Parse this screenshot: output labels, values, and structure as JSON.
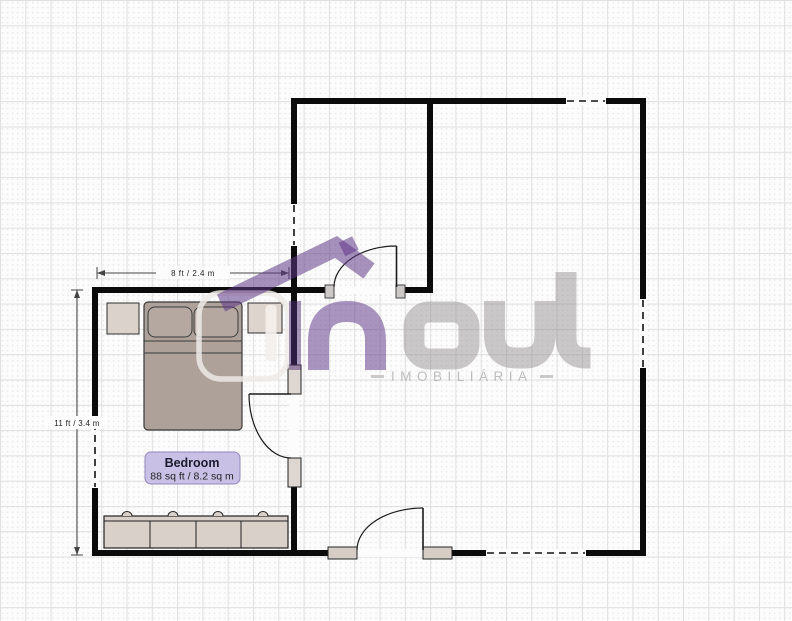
{
  "room": {
    "name": "Bedroom",
    "area": "88 sq ft / 8.2 sq m"
  },
  "dimensions": {
    "width": "8 ft / 2.4 m",
    "height": "11 ft / 3.4 m"
  },
  "watermark": {
    "brand": "inout",
    "brand_in_text": "in",
    "brand_out_text": "out",
    "subtitle": "IMOBILIÁRIA",
    "colors": {
      "purple": "#5f3787",
      "gray": "#8c8787",
      "outline": "#eeeae7"
    },
    "elements": [
      {
        "tag": "rect",
        "name": "logo-house-outline",
        "inter": false,
        "x": 199,
        "y": 293,
        "width": 89,
        "height": 86,
        "rx": 22,
        "fill": "none",
        "stroke": "rgba(238,234,231,0.85)",
        "stroke-width": 5.5
      },
      {
        "tag": "rect",
        "name": "logo-house-door",
        "inter": false,
        "x": 265.5,
        "y": 305,
        "width": 11,
        "height": 56,
        "rx": 3.5,
        "fill": "rgba(244,240,236,0.9)"
      },
      {
        "tag": "path",
        "name": "logo-roof",
        "inter": false,
        "d": "M221,303 L336,247 L369,271",
        "fill": "none",
        "stroke": "rgba(95,55,135,0.55)",
        "stroke-width": 19,
        "stroke-linejoin": "miter"
      },
      {
        "tag": "rect",
        "name": "logo-chimney",
        "inter": false,
        "x": 341,
        "y": 239,
        "width": 15,
        "height": 15,
        "transform": "rotate(-26 348 246)",
        "fill": "rgba(95,55,135,0.55)"
      },
      {
        "tag": "rect",
        "name": "logo-letter-i",
        "inter": false,
        "x": 289,
        "y": 301,
        "width": 12,
        "height": 69,
        "fill": "rgba(80,45,120,0.5)"
      },
      {
        "tag": "path",
        "name": "logo-letter-n",
        "inter": false,
        "d": "M318.5,370 L318.5,341 Q318.5,311.5 347,311.5 Q375.5,311.5 375.5,341 L375.5,370",
        "fill": "none",
        "stroke": "rgba(100,62,140,0.55)",
        "stroke-width": 21
      },
      {
        "tag": "rect",
        "name": "logo-letter-o",
        "inter": false,
        "x": 414,
        "y": 312,
        "width": 55,
        "height": 47,
        "rx": 15,
        "fill": "none",
        "stroke": "rgba(140,135,135,0.45)",
        "stroke-width": 21
      },
      {
        "tag": "path",
        "name": "logo-letter-u",
        "inter": false,
        "d": "M494.5,301 L494.5,335 Q494.5,358 516,358 L524,358 Q545,358 545,335 L545,301",
        "fill": "none",
        "stroke": "rgba(140,135,135,0.45)",
        "stroke-width": 21
      },
      {
        "tag": "path",
        "name": "logo-letter-t",
        "inter": false,
        "d": "M566,272 L566,337 Q566,358 586,358 L590.5,358",
        "fill": "none",
        "stroke": "rgba(140,135,135,0.45)",
        "stroke-width": 21
      }
    ]
  },
  "plan": {
    "wall_color": "#0b0b0b",
    "elements": [
      {
        "tag": "rect",
        "name": "nightstand",
        "inter": true,
        "x": 107,
        "y": 303,
        "width": 32,
        "height": 31,
        "fill": "#dbd2cb",
        "stroke": "#2e2e2e",
        "stroke-width": 1
      },
      {
        "tag": "rect",
        "name": "cabinet",
        "inter": true,
        "x": 248,
        "y": 303,
        "width": 34,
        "height": 30,
        "fill": "#ddd4cd",
        "stroke": "#2e2e2e",
        "stroke-width": 1
      },
      {
        "tag": "rect",
        "name": "bed",
        "inter": true,
        "x": 144,
        "y": 302,
        "width": 98,
        "height": 128,
        "rx": 4,
        "fill": "#ada19a",
        "stroke": "#3a3a3a",
        "stroke-width": 1.2
      },
      {
        "tag": "rect",
        "name": "bed-pillow",
        "inter": false,
        "x": 148,
        "y": 307,
        "width": 44,
        "height": 30,
        "rx": 7,
        "fill": "#b4a8a1",
        "stroke": "#3a3a3a",
        "stroke-width": 1
      },
      {
        "tag": "rect",
        "name": "bed-pillow",
        "inter": false,
        "x": 194,
        "y": 307,
        "width": 44,
        "height": 30,
        "rx": 7,
        "fill": "#b4a8a1",
        "stroke": "#3a3a3a",
        "stroke-width": 1
      },
      {
        "tag": "line",
        "name": "bed-fold-line",
        "inter": false,
        "x1": 144,
        "y1": 341,
        "x2": 242,
        "y2": 341,
        "stroke": "#3a3a3a",
        "stroke-width": 1
      },
      {
        "tag": "line",
        "name": "bed-fold-line",
        "inter": false,
        "x1": 144,
        "y1": 353,
        "x2": 242,
        "y2": 353,
        "stroke": "#3a3a3a",
        "stroke-width": 1
      },
      {
        "tag": "rect",
        "name": "dresser",
        "inter": true,
        "x": 104,
        "y": 516,
        "width": 184,
        "height": 32,
        "fill": "#d9d0c9",
        "stroke": "#222222",
        "stroke-width": 1.2
      },
      {
        "tag": "line",
        "name": "dresser-top-edge",
        "inter": false,
        "x1": 104,
        "y1": 521,
        "x2": 288,
        "y2": 521,
        "stroke": "#222222",
        "stroke-width": 1
      },
      {
        "tag": "line",
        "name": "dresser-divider",
        "inter": false,
        "x1": 150,
        "y1": 521,
        "x2": 150,
        "y2": 548,
        "stroke": "#222222",
        "stroke-width": 1
      },
      {
        "tag": "line",
        "name": "dresser-divider",
        "inter": false,
        "x1": 196,
        "y1": 521,
        "x2": 196,
        "y2": 548,
        "stroke": "#222222",
        "stroke-width": 1
      },
      {
        "tag": "line",
        "name": "dresser-divider",
        "inter": false,
        "x1": 241,
        "y1": 521,
        "x2": 241,
        "y2": 548,
        "stroke": "#222222",
        "stroke-width": 1
      },
      {
        "tag": "path",
        "name": "dresser-knob",
        "inter": false,
        "d": "M122,516 A5,4.5 0 0 1 132,516",
        "fill": "#d9d0c9",
        "stroke": "#222222",
        "stroke-width": 1
      },
      {
        "tag": "path",
        "name": "dresser-knob",
        "inter": false,
        "d": "M168,516 A5,4.5 0 0 1 178,516",
        "fill": "#d9d0c9",
        "stroke": "#222222",
        "stroke-width": 1
      },
      {
        "tag": "path",
        "name": "dresser-knob",
        "inter": false,
        "d": "M213,516 A5,4.5 0 0 1 223,516",
        "fill": "#d9d0c9",
        "stroke": "#222222",
        "stroke-width": 1
      },
      {
        "tag": "path",
        "name": "dresser-knob",
        "inter": false,
        "d": "M258,516 A5,4.5 0 0 1 268,516",
        "fill": "#d9d0c9",
        "stroke": "#222222",
        "stroke-width": 1
      },
      {
        "tag": "rect",
        "name": "wall-top",
        "inter": true,
        "x": 291,
        "y": 98,
        "width": 355,
        "height": 6,
        "fill": "#0b0b0b"
      },
      {
        "tag": "rect",
        "name": "wall-right",
        "inter": true,
        "x": 640,
        "y": 98,
        "width": 6,
        "height": 458,
        "fill": "#0b0b0b"
      },
      {
        "tag": "rect",
        "name": "wall-bottom",
        "inter": true,
        "x": 92,
        "y": 550,
        "width": 554,
        "height": 6,
        "fill": "#0b0b0b"
      },
      {
        "tag": "rect",
        "name": "wall-bedroom-left",
        "inter": true,
        "x": 92,
        "y": 287,
        "width": 6,
        "height": 269,
        "fill": "#0b0b0b"
      },
      {
        "tag": "rect",
        "name": "wall-middle-vertical",
        "inter": true,
        "x": 291,
        "y": 98,
        "width": 6,
        "height": 458,
        "fill": "#0b0b0b"
      },
      {
        "tag": "rect",
        "name": "wall-interior-vertical",
        "inter": true,
        "x": 427,
        "y": 98,
        "width": 6,
        "height": 195,
        "fill": "#0b0b0b"
      },
      {
        "tag": "rect",
        "name": "wall-bedroom-top",
        "inter": true,
        "x": 92,
        "y": 287,
        "width": 341,
        "height": 6,
        "fill": "#0b0b0b"
      },
      {
        "tag": "rect",
        "name": "door-opening",
        "inter": false,
        "x": 334,
        "y": 286,
        "width": 62,
        "height": 8,
        "fill": "#fcfcfc"
      },
      {
        "tag": "rect",
        "name": "door-opening",
        "inter": false,
        "x": 289,
        "y": 394,
        "width": 10,
        "height": 64,
        "fill": "#fcfcfc"
      },
      {
        "tag": "rect",
        "name": "door-opening",
        "inter": false,
        "x": 357,
        "y": 549,
        "width": 66,
        "height": 8,
        "fill": "#fcfcfc"
      },
      {
        "tag": "rect",
        "name": "window",
        "inter": true,
        "x": 566,
        "y": 97,
        "width": 40,
        "height": 8,
        "fill": "#fcfcfc"
      },
      {
        "tag": "line",
        "name": "window-dash",
        "inter": false,
        "x1": 567,
        "y1": 101,
        "x2": 605,
        "y2": 101,
        "stroke": "#111111",
        "stroke-width": 1.6,
        "stroke-dasharray": "7,5"
      },
      {
        "tag": "rect",
        "name": "window",
        "inter": true,
        "x": 639,
        "y": 299,
        "width": 8,
        "height": 69,
        "fill": "#fcfcfc"
      },
      {
        "tag": "line",
        "name": "window-dash",
        "inter": false,
        "x1": 643,
        "y1": 300,
        "x2": 643,
        "y2": 367,
        "stroke": "#111111",
        "stroke-width": 1.6,
        "stroke-dasharray": "7,5"
      },
      {
        "tag": "rect",
        "name": "window",
        "inter": true,
        "x": 486,
        "y": 549,
        "width": 100,
        "height": 8,
        "fill": "#fcfcfc"
      },
      {
        "tag": "line",
        "name": "window-dash",
        "inter": false,
        "x1": 487,
        "y1": 553,
        "x2": 585,
        "y2": 553,
        "stroke": "#111111",
        "stroke-width": 1.6,
        "stroke-dasharray": "7,5"
      },
      {
        "tag": "rect",
        "name": "window",
        "inter": true,
        "x": 91,
        "y": 422,
        "width": 8,
        "height": 66,
        "fill": "#fcfcfc"
      },
      {
        "tag": "line",
        "name": "window-dash",
        "inter": false,
        "x1": 95,
        "y1": 423,
        "x2": 95,
        "y2": 487,
        "stroke": "#111111",
        "stroke-width": 1.6,
        "stroke-dasharray": "7,5"
      },
      {
        "tag": "rect",
        "name": "window",
        "inter": true,
        "x": 290,
        "y": 204,
        "width": 8,
        "height": 42,
        "fill": "#fcfcfc"
      },
      {
        "tag": "line",
        "name": "window-dash",
        "inter": false,
        "x1": 294,
        "y1": 205,
        "x2": 294,
        "y2": 245,
        "stroke": "#111111",
        "stroke-width": 1.6,
        "stroke-dasharray": "7,5"
      },
      {
        "tag": "rect",
        "name": "door-jamb",
        "inter": false,
        "x": 325,
        "y": 285,
        "width": 9,
        "height": 13,
        "fill": "#cdc9c8",
        "stroke": "#444444",
        "stroke-width": 1
      },
      {
        "tag": "rect",
        "name": "door-jamb",
        "inter": false,
        "x": 396,
        "y": 285,
        "width": 9,
        "height": 13,
        "fill": "#cdc9c8",
        "stroke": "#444444",
        "stroke-width": 1
      },
      {
        "tag": "rect",
        "name": "door-jamb",
        "inter": false,
        "x": 288,
        "y": 365,
        "width": 13,
        "height": 29,
        "fill": "#ded6d1",
        "stroke": "#222222",
        "stroke-width": 1
      },
      {
        "tag": "rect",
        "name": "door-jamb",
        "inter": false,
        "x": 288,
        "y": 458,
        "width": 13,
        "height": 29,
        "fill": "#ded6d1",
        "stroke": "#222222",
        "stroke-width": 1
      },
      {
        "tag": "rect",
        "name": "door-jamb",
        "inter": false,
        "x": 328,
        "y": 547,
        "width": 29,
        "height": 12,
        "fill": "#d6cdc6",
        "stroke": "#222222",
        "stroke-width": 1
      },
      {
        "tag": "rect",
        "name": "door-jamb",
        "inter": false,
        "x": 423,
        "y": 547,
        "width": 29,
        "height": 12,
        "fill": "#d6cdc6",
        "stroke": "#222222",
        "stroke-width": 1
      },
      {
        "tag": "line",
        "name": "door-leaf",
        "inter": true,
        "x1": 396.5,
        "y1": 246,
        "x2": 396.5,
        "y2": 287,
        "stroke": "#1a1a1a",
        "stroke-width": 1.6
      },
      {
        "tag": "path",
        "name": "door-swing-arc",
        "inter": false,
        "d": "M334,287 A62,41 0 0 1 396.5,246",
        "fill": "none",
        "stroke": "#1a1a1a",
        "stroke-width": 1.2
      },
      {
        "tag": "line",
        "name": "door-leaf",
        "inter": true,
        "x1": 249,
        "y1": 394,
        "x2": 291,
        "y2": 394,
        "stroke": "#1a1a1a",
        "stroke-width": 1.6
      },
      {
        "tag": "path",
        "name": "door-swing-arc",
        "inter": false,
        "d": "M249,394 A42,64 0 0 0 291,458",
        "fill": "none",
        "stroke": "#1a1a1a",
        "stroke-width": 1.2
      },
      {
        "tag": "line",
        "name": "door-leaf",
        "inter": true,
        "x1": 423,
        "y1": 508,
        "x2": 423,
        "y2": 550,
        "stroke": "#1a1a1a",
        "stroke-width": 1.6
      },
      {
        "tag": "path",
        "name": "door-swing-arc",
        "inter": false,
        "d": "M423,508 A66,42 0 0 0 357,550",
        "fill": "none",
        "stroke": "#1a1a1a",
        "stroke-width": 1.2
      },
      {
        "tag": "line",
        "name": "dimension-line-width",
        "inter": false,
        "x1": 97,
        "y1": 273,
        "x2": 289,
        "y2": 273,
        "stroke": "#444444",
        "stroke-width": 1
      },
      {
        "tag": "line",
        "name": "dimension-tick",
        "inter": false,
        "x1": 97,
        "y1": 267,
        "x2": 97,
        "y2": 279,
        "stroke": "#444444",
        "stroke-width": 1
      },
      {
        "tag": "line",
        "name": "dimension-tick",
        "inter": false,
        "x1": 289,
        "y1": 267,
        "x2": 289,
        "y2": 279,
        "stroke": "#444444",
        "stroke-width": 1
      },
      {
        "tag": "path",
        "name": "dimension-arrow",
        "inter": false,
        "d": "M97,273 L105,270 L105,276 Z",
        "fill": "#444444"
      },
      {
        "tag": "path",
        "name": "dimension-arrow",
        "inter": false,
        "d": "M289,273 L281,270 L281,276 Z",
        "fill": "#444444"
      },
      {
        "tag": "rect",
        "name": "dimension-label-bg",
        "inter": false,
        "x": 156,
        "y": 266,
        "width": 74,
        "height": 13,
        "fill": "#fcfcfc"
      },
      {
        "tag": "text",
        "name": "dimension-label-width",
        "inter": false,
        "x": 193,
        "y": 276,
        "text-anchor": "middle",
        "font-size": 8,
        "letter-spacing": 0.5,
        "fill": "#222222",
        "bind": "dimensions.width"
      },
      {
        "tag": "line",
        "name": "dimension-line-height",
        "inter": false,
        "x1": 77,
        "y1": 290,
        "x2": 77,
        "y2": 555,
        "stroke": "#444444",
        "stroke-width": 1
      },
      {
        "tag": "line",
        "name": "dimension-tick",
        "inter": false,
        "x1": 71,
        "y1": 290,
        "x2": 83,
        "y2": 290,
        "stroke": "#444444",
        "stroke-width": 1
      },
      {
        "tag": "line",
        "name": "dimension-tick",
        "inter": false,
        "x1": 71,
        "y1": 555,
        "x2": 83,
        "y2": 555,
        "stroke": "#444444",
        "stroke-width": 1
      },
      {
        "tag": "path",
        "name": "dimension-arrow",
        "inter": false,
        "d": "M77,290 L74,298 L80,298 Z",
        "fill": "#444444"
      },
      {
        "tag": "path",
        "name": "dimension-arrow",
        "inter": false,
        "d": "M77,555 L74,547 L80,547 Z",
        "fill": "#444444"
      },
      {
        "tag": "rect",
        "name": "dimension-label-bg",
        "inter": false,
        "x": 47,
        "y": 416,
        "width": 60,
        "height": 13,
        "fill": "#fcfcfc"
      },
      {
        "tag": "text",
        "name": "dimension-label-height",
        "inter": false,
        "x": 77,
        "y": 426,
        "text-anchor": "middle",
        "font-size": 8,
        "letter-spacing": 0.3,
        "fill": "#222222",
        "bind": "dimensions.height"
      },
      {
        "tag": "rect",
        "name": "room-label",
        "inter": true,
        "x": 145,
        "y": 452,
        "width": 95,
        "height": 32,
        "rx": 6,
        "fill": "#c9c0e5",
        "stroke": "#9489bd",
        "stroke-width": 1
      },
      {
        "tag": "text",
        "name": "room-name",
        "inter": false,
        "x": 192,
        "y": 467,
        "text-anchor": "middle",
        "font-size": 12.5,
        "font-weight": "bold",
        "fill": "#1b1b2e",
        "bind": "room.name"
      },
      {
        "tag": "text",
        "name": "room-area",
        "inter": false,
        "x": 192,
        "y": 479.5,
        "text-anchor": "middle",
        "font-size": 10.5,
        "fill": "#222222",
        "bind": "room.area"
      }
    ]
  }
}
